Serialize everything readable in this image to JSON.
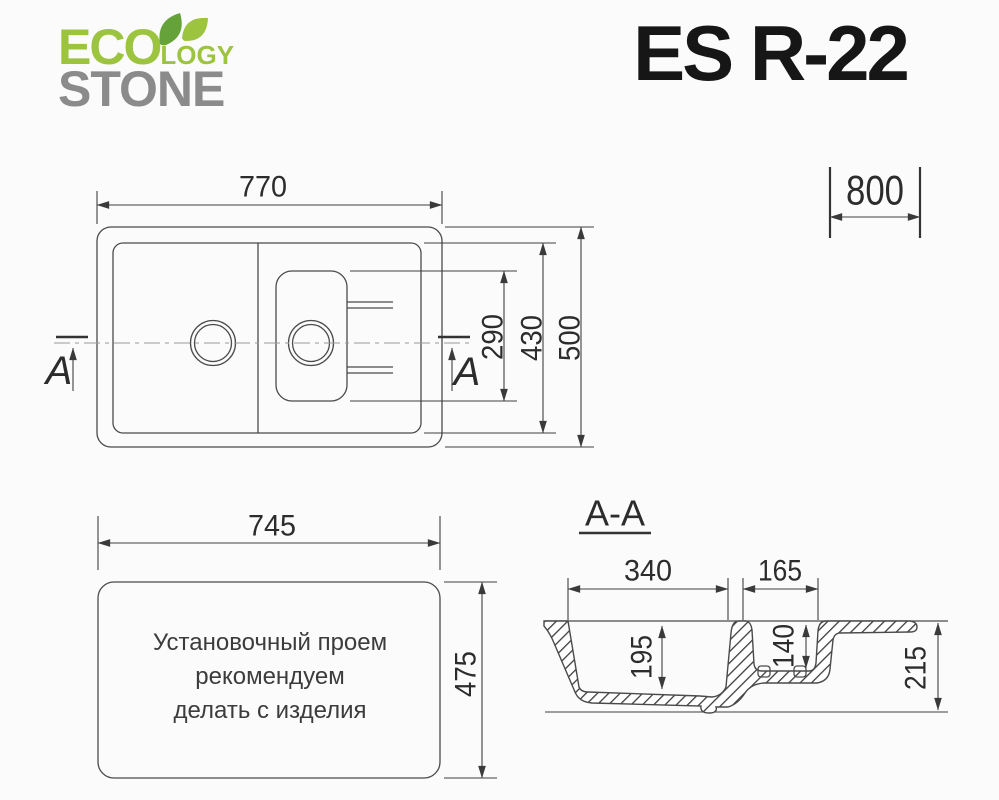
{
  "brand": {
    "eco": "ECO",
    "logy": "LOGY",
    "stone": "STONE",
    "green": "#9cc43f",
    "leaf_green_dark": "#66a23a",
    "gray": "#8b8b8b"
  },
  "model": "ES R-22",
  "cabinet_width": "800",
  "plan_view": {
    "overall_width": "770",
    "overall_depth": "500",
    "inner_depth": "430",
    "small_bowl_depth": "290",
    "section_marker": "A"
  },
  "cutout_view": {
    "width": "745",
    "depth": "475",
    "note_lines": [
      "Установочный проем",
      "рекомендуем",
      "делать с изделия"
    ]
  },
  "section_view": {
    "label": "A-A",
    "main_bowl_width": "340",
    "small_bowl_width": "165",
    "main_bowl_depth": "195",
    "small_bowl_depth": "140",
    "overall_height": "215"
  },
  "line_color": "#4a4a4a"
}
